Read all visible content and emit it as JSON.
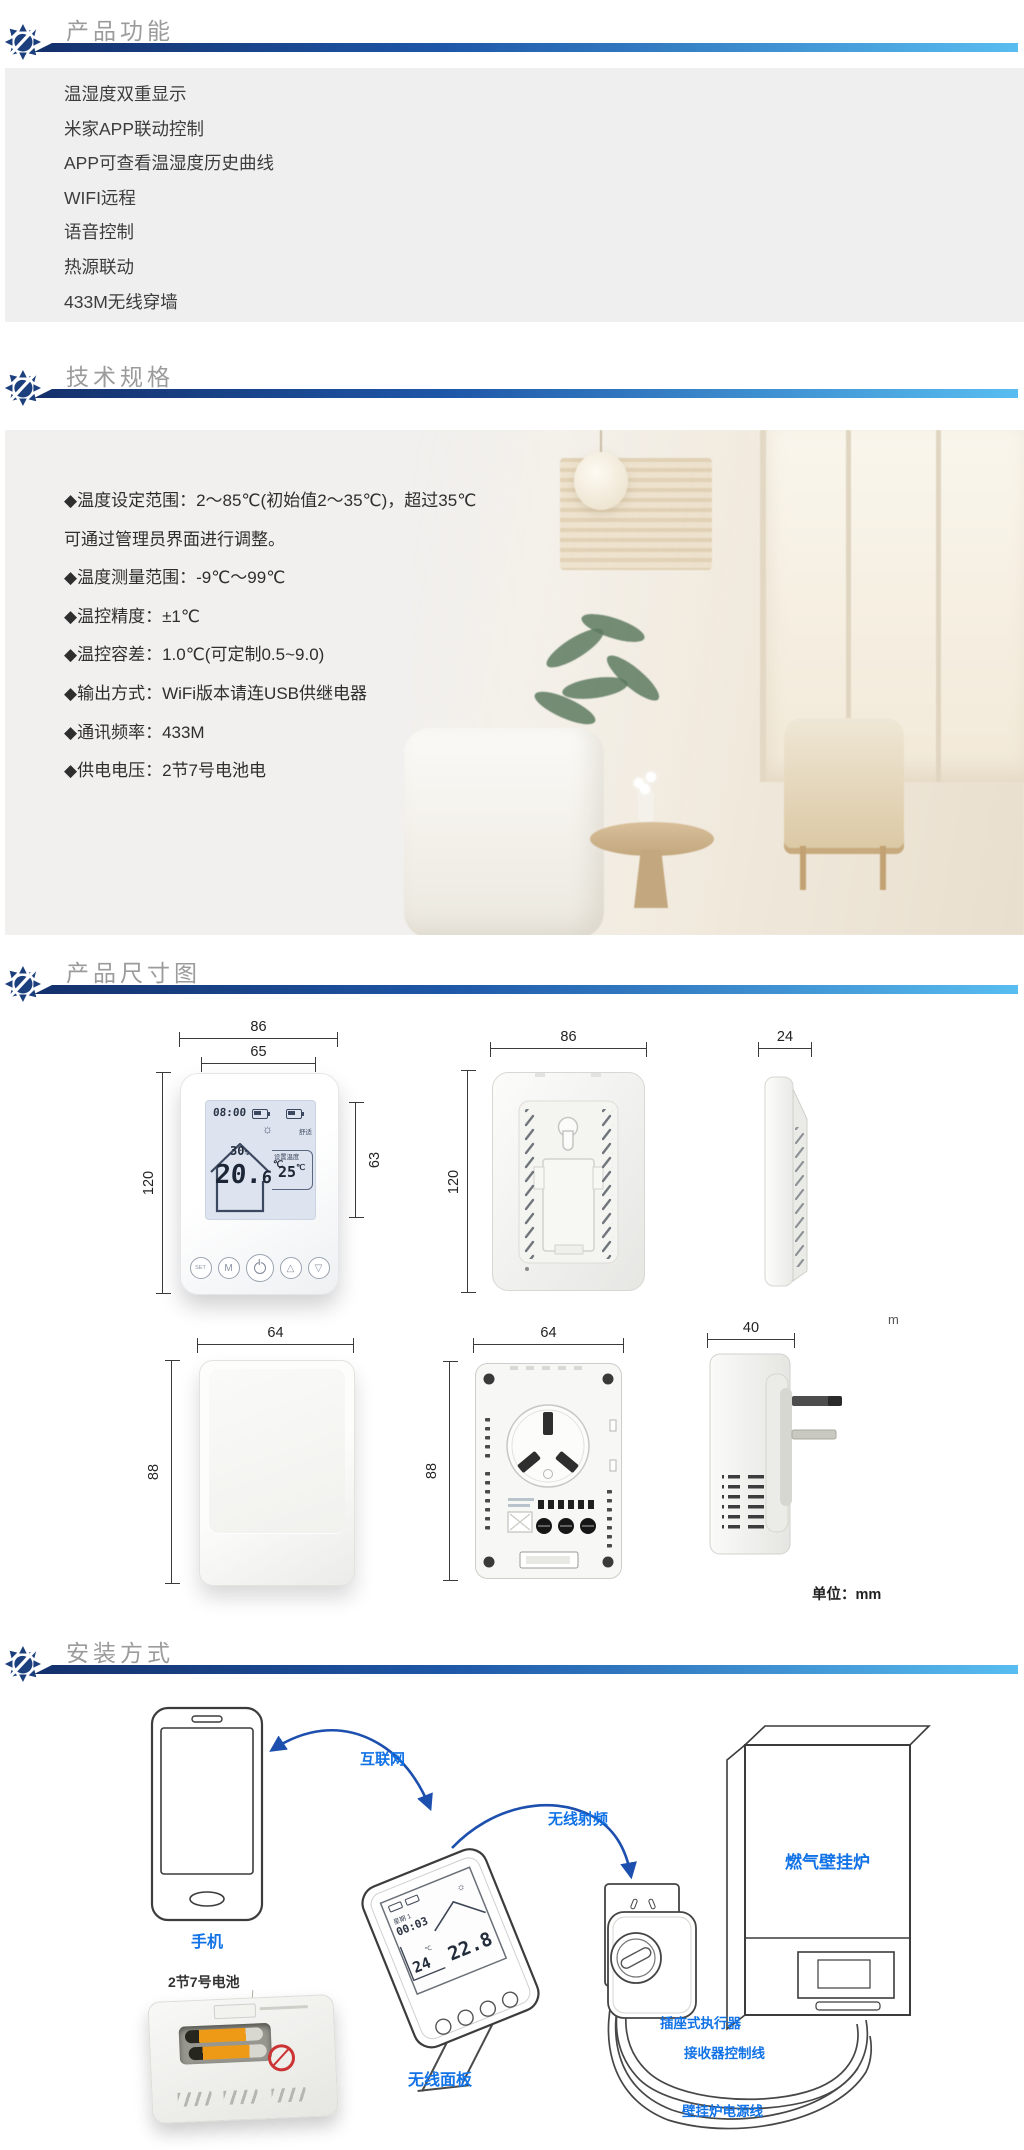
{
  "colors": {
    "bar_dark": "#14306b",
    "bar_mid": "#1e57a8",
    "bar_light": "#58bdf0",
    "title_gray": "#9b9b9b",
    "label_blue": "#1273e6",
    "arrow_blue": "#1c4fae",
    "panel_gray": "#efeff0"
  },
  "icons": {
    "sun": "☼",
    "up": "△",
    "down": "▽"
  },
  "sections": {
    "features": {
      "title": "产品功能",
      "items": [
        "温湿度双重显示",
        "米家APP联动控制",
        "APP可查看温湿度历史曲线",
        "WIFI远程",
        "语音控制",
        "热源联动",
        "433M无线穿墙"
      ]
    },
    "specs": {
      "title": "技术规格",
      "lines": [
        "◆温度设定范围：2～85℃(初始值2～35℃)，超过35℃",
        "可通过管理员界面进行调整。",
        "◆温度测量范围：-9℃～99℃",
        "◆温控精度：±1℃",
        "◆温控容差：1.0℃(可定制0.5~9.0)",
        "◆输出方式：WiFi版本请连USB供继电器",
        "◆通讯频率：433M",
        "◆供电电压：2节7号电池电"
      ]
    },
    "dimensions": {
      "title": "产品尺寸图",
      "unit_note": "单位：mm",
      "stray_text": "m",
      "front": {
        "w_outer": "86",
        "w_inner": "65",
        "h": "120",
        "screen_h": "63"
      },
      "back": {
        "w": "86",
        "h": "120"
      },
      "side": {
        "w": "24"
      },
      "socket_front": {
        "w": "64",
        "h": "88"
      },
      "socket_back": {
        "w": "64",
        "h": "88"
      },
      "socket_side": {
        "w": "40"
      },
      "lcd": {
        "time": "08:00",
        "mode": "舒适",
        "humidity": "30",
        "humidity_unit": "%",
        "temp_main": "20.",
        "temp_dec": "6",
        "temp_unit": "℃",
        "set_label": "设置温度",
        "set_value": "25",
        "set_unit": "℃"
      },
      "buttons": {
        "set": "SET",
        "mode": "M"
      }
    },
    "install": {
      "title": "安装方式",
      "labels": {
        "phone": "手机",
        "battery": "2节7号电池",
        "panel": "无线面板",
        "internet": "互联网",
        "rf": "无线射频",
        "boiler": "燃气壁挂炉",
        "actuator": "插座式执行器",
        "receiver_line": "接收器控制线",
        "boiler_power_line": "壁挂炉电源线"
      },
      "panel_lcd": {
        "week": "星期 1",
        "time": "00:03",
        "set_value": "24",
        "set_unit": "℃",
        "current": "22.8"
      }
    }
  }
}
